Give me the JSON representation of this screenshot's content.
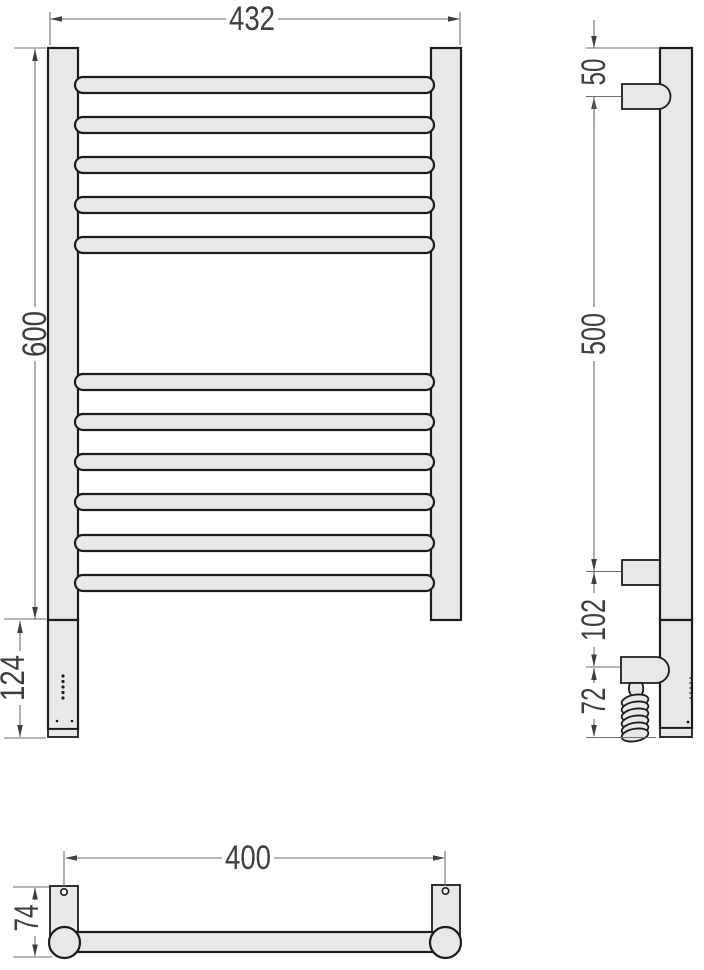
{
  "colors": {
    "background": "#ffffff",
    "outline": "#1c1c1c",
    "metal_fill": "#e8e8e8",
    "dim_line": "#6e6e6e",
    "dim_text": "#3f3f3f"
  },
  "views": {
    "front": {
      "name": "front view",
      "rung_count": 11,
      "dims": {
        "overall_width": "432",
        "rail_height": "600",
        "element_section_height": "124"
      }
    },
    "side": {
      "name": "side view",
      "dims": {
        "top_to_upper_bracket": "50",
        "upper_to_lower_bracket": "500",
        "lower_bracket_to_element": "102",
        "element_to_cable_end": "72"
      }
    },
    "top": {
      "name": "top view",
      "dims": {
        "mounting_distance": "400",
        "depth": "74"
      }
    }
  }
}
